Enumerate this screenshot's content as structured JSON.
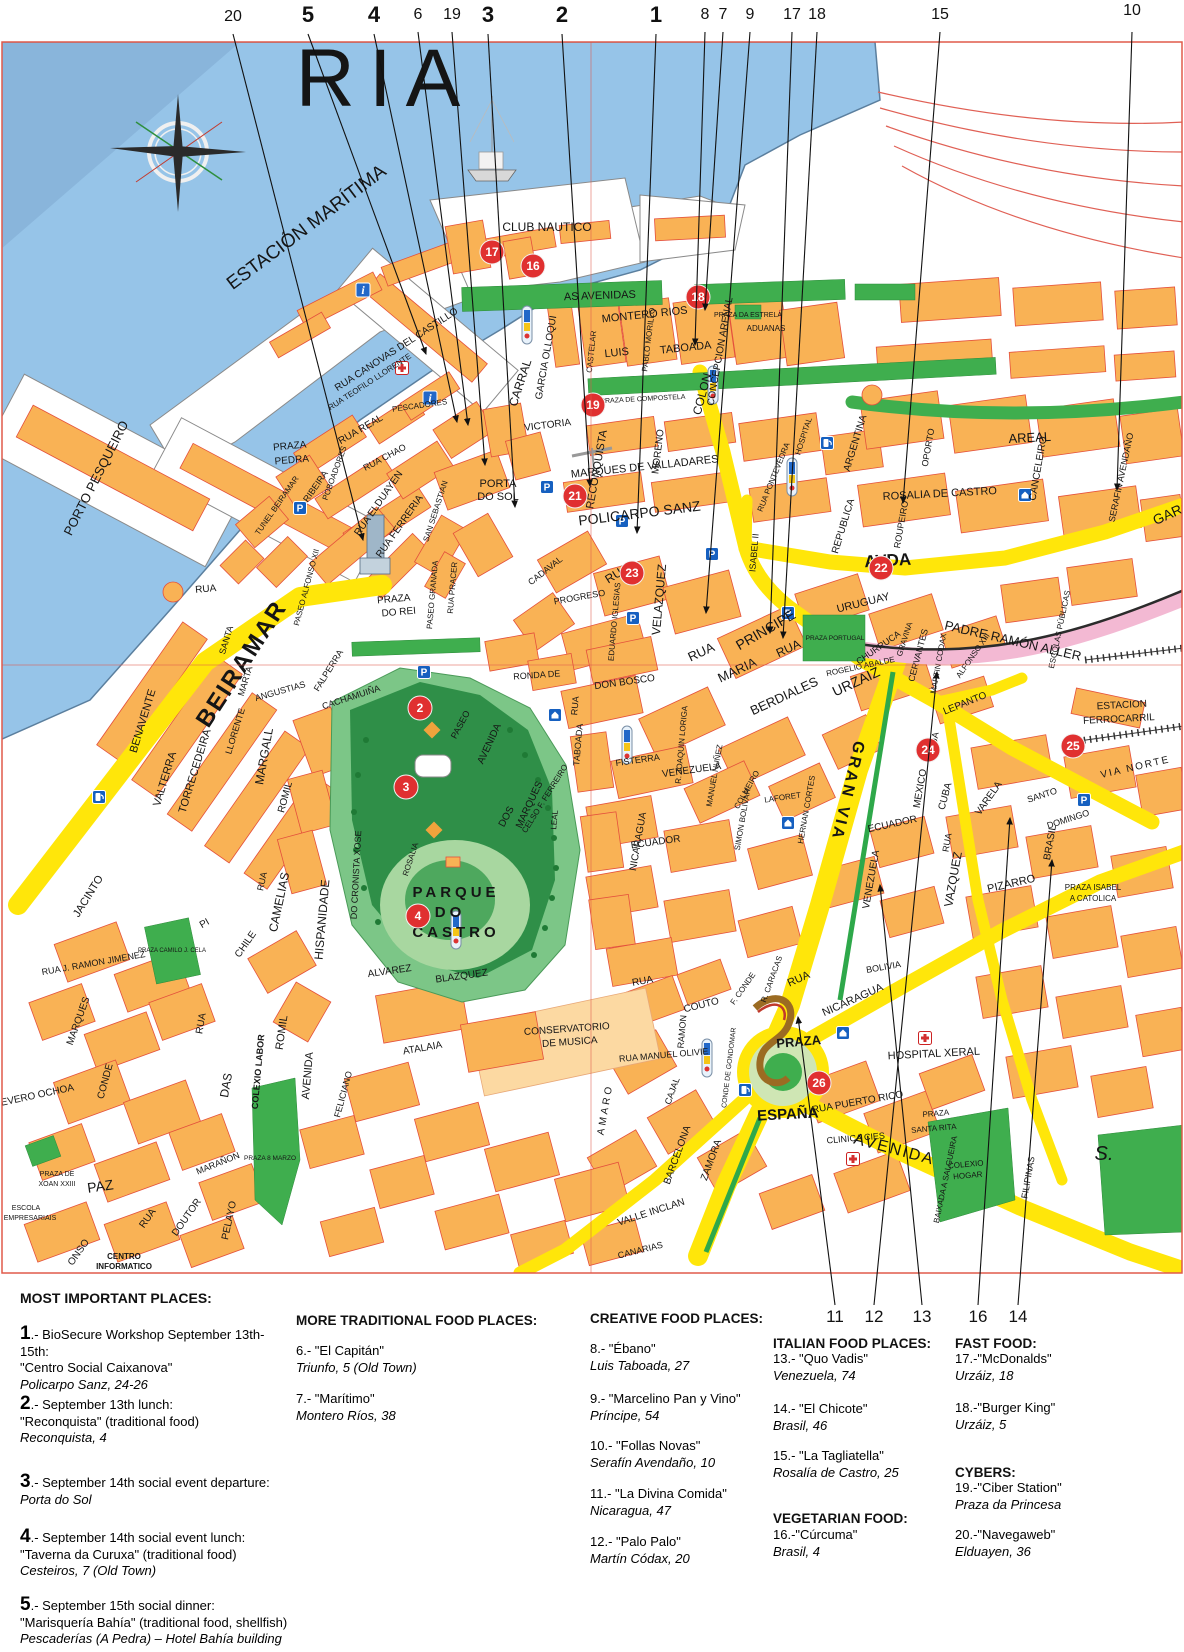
{
  "colors": {
    "water": "#96c4e8",
    "building": "#f9b255",
    "road_yellow": "#ffe60a",
    "park_green": "#2f9e45",
    "strip_green": "#3fae4e",
    "railway_pink": "#f3b9d3",
    "marker_red": "#e03030",
    "sign_blue": "#1660c0",
    "border_red": "#e05a4a"
  },
  "icons": {
    "parking": "P",
    "info": "i"
  },
  "top_callouts": [
    {
      "n": "20",
      "bold": false
    },
    {
      "n": "5",
      "bold": true
    },
    {
      "n": "4",
      "bold": true
    },
    {
      "n": "6",
      "bold": false
    },
    {
      "n": "19",
      "bold": false
    },
    {
      "n": "3",
      "bold": true
    },
    {
      "n": "2",
      "bold": true
    },
    {
      "n": "1",
      "bold": true
    },
    {
      "n": "8",
      "bold": false
    },
    {
      "n": "7",
      "bold": false
    },
    {
      "n": "9",
      "bold": false
    },
    {
      "n": "17",
      "bold": false
    },
    {
      "n": "18",
      "bold": false
    },
    {
      "n": "15",
      "bold": false
    },
    {
      "n": "10",
      "bold": false
    }
  ],
  "bottom_callouts": [
    "11",
    "12",
    "13",
    "16",
    "14"
  ],
  "map": {
    "markers": [
      "17",
      "16",
      "18",
      "19",
      "21",
      "22",
      "23",
      "2",
      "3",
      "4",
      "24",
      "25",
      "26"
    ],
    "labels": [
      "ESTACIÓN MARÍTIMA",
      "CLUB NAUTICO",
      "PORTO PESQUEIRO",
      "BEIRAMAR",
      "AS AVENIDAS",
      "MONTERO RIOS",
      "LUIS",
      "TABOADA",
      "PABLO MORILLO",
      "GARCIA OLLOQUI",
      "CASTELAR",
      "CARRAL",
      "VICTORIA",
      "CONCEPCION ARENAL",
      "PRAZA DA ESTRELA",
      "ADUANAS",
      "PRAZA DE COMPOSTELA",
      "COLON",
      "AREAL",
      "ROSALIA DE CASTRO",
      "ARGENTINA",
      "REPUBLICA",
      "OPORTO",
      "ROUPEIRO",
      "CANCELEIRO",
      "SERAFIN AVENDAÑO",
      "HOSPITAL",
      "RUA PONTEVEDRA",
      "AVDA",
      "GARC",
      "RUA CANOVAS DEL CASTILLO",
      "RUA TEOFILO LLORENTE",
      "RUA REAL",
      "RUA CHAO",
      "PRAZA",
      "PEDRA",
      "PESCADORES",
      "PORTA",
      "DO SOL",
      "RUA ELDUAYEN",
      "RUA FERRERIA",
      "SAN SEBASTIAN",
      "POBOADORES",
      "RIBEIRA",
      "TUNEL BEIRAMAR",
      "RECONQUISTA",
      "MORENO",
      "VELAZQUEZ",
      "MARQUES DE VALLADARES",
      "POLICARPO SANZ",
      "RUA",
      "PRINCIPE",
      "EDUARDO IGLESIAS",
      "PROGRESO",
      "CADAVAL",
      "DON BOSCO",
      "RONDA DE",
      "RUA",
      "MARIA",
      "BERDIALES",
      "RUA",
      "URZAIZ",
      "ISABEL II",
      "URUGUAY",
      "PRAZA PORTUGAL",
      "CHURRUCA",
      "GRAVINA",
      "ROGELIO ABALDE",
      "CERVANTES",
      "MARTIN CODAX",
      "ALFONSO XIII",
      "PADRE RAMÓN ALLER",
      "ESCOLAS PÚBLICAS",
      "LEPANTO",
      "ESTACION",
      "FERROCARRIL",
      "VIA NORTE",
      "FISTERRA",
      "R. JOAQUIN LORIGA",
      "MANUEL NUÑEZ",
      "COLMEIRO",
      "LAFORET",
      "HERNAN CORTES",
      "ECUADOR",
      "ECUADOR",
      "VENEZUELA",
      "VENEZUELA",
      "NICARAGUA",
      "SIMON BOLIVAR",
      "RUA",
      "TABOADA",
      "LEAL",
      "BOLIVIA",
      "GRAN VIA",
      "MEXICO",
      "CUBA",
      "RUA",
      "VAZQUEZ",
      "RUA",
      "VARELA",
      "SANTO",
      "DOMINGO",
      "BRASIL",
      "PIZARRO",
      "PRAZA ISABEL",
      "A CATOLICA",
      "HOSPITAL XERAL",
      "RUA PUERTO RICO",
      "PRAZA",
      "SANTA RITA",
      "BAIXADA A SALGUEIRA",
      "CLINICA CIES",
      "RUA",
      "NICARAGUA",
      "PRAZA",
      "ESPAÑA",
      "RUA MANUEL OLIVIE",
      "CONDE DE GONDOMAR",
      "RAMON",
      "CAJAL",
      "F. CONDE",
      "R. CARACAS",
      "RUA",
      "COUTO",
      "BARCELONA",
      "ZAMORA",
      "VALLE INCLAN",
      "AMARO",
      "CANARIAS",
      "AVENIDA",
      "COLEXIO",
      "HOGAR",
      "FILIPINAS",
      "S.",
      "CONSERVATORIO",
      "DE MUSICA",
      "ATALAIA",
      "ALVAREZ",
      "BLAZQUEZ",
      "FELICIANO",
      "PARQUE",
      "DO",
      "CASTRO",
      "PASEO",
      "AVENIDA",
      "DOS",
      "MARQUES",
      "CELSO F. FERREIRO",
      "ROSALIA",
      "DO CRONISTA XOSE",
      "FALPERRA",
      "CACHAMUIÑA",
      "PRAZA",
      "DO REI",
      "PASEO ALFONSO XII",
      "PASEO GRANADA",
      "RUA PRACER",
      "HISPANIDADE",
      "CAMELIAS",
      "RUA",
      "CHILE",
      "PI",
      "JACINTO",
      "RUA J. RAMON JIMENEZ",
      "MARQUES",
      "CONDE",
      "EVERO OCHOA",
      "PRAZA DE",
      "XOAN XXIII",
      "PAZ",
      "ESCOLA",
      "EMPRESARIAIS",
      "RUA",
      "DOUTOR",
      "PELAYO",
      "MARAÑON",
      "DAS",
      "RUA",
      "COLEXIO LABOR",
      "ROMIL",
      "AVENIDA",
      "ROMIL",
      "MARGALL",
      "ANGUSTIAS",
      "LLORENTE",
      "SANTA",
      "MARTA",
      "TORRECEDEIRA",
      "VALTERRA",
      "BENAVENTE",
      "RUA",
      "CENTRO",
      "INFORMATICO",
      "ONSO",
      "PRAZA CAMILO J. CELA",
      "PRAZA 8 MARZO",
      "RIA"
    ]
  },
  "legend": {
    "important": {
      "heading": "MOST IMPORTANT PLACES:",
      "items": [
        {
          "num": "1",
          "head": ".- BioSecure Workshop September 13th-15th:",
          "body": "\"Centro Social Caixanova\"",
          "addr": "Policarpo Sanz, 24-26"
        },
        {
          "num": "2",
          "head": ".- September 13th lunch:",
          "body": "\"Reconquista\" (traditional food)",
          "addr": "Reconquista, 4"
        },
        {
          "num": "3",
          "head": ".- September 14th social event departure:",
          "addr": "Porta do Sol"
        },
        {
          "num": "4",
          "head": ".- September 14th social event lunch:",
          "body": "\"Taverna da Curuxa\" (traditional food)",
          "addr": "Cesteiros, 7 (Old Town)"
        },
        {
          "num": "5",
          "head": ".- September 15th social dinner:",
          "body": "\"Marisquería Bahía\" (traditional food, shellfish)",
          "addr": "Pescaderías (A Pedra) – Hotel Bahía building"
        }
      ]
    },
    "traditional": {
      "heading": "MORE TRADITIONAL FOOD PLACES:",
      "items": [
        {
          "name": "6.- \"El Capitán\"",
          "addr": "Triunfo, 5 (Old Town)"
        },
        {
          "name": "7.- \"Marítimo\"",
          "addr": "Montero Ríos, 38"
        }
      ]
    },
    "creative": {
      "heading": "CREATIVE FOOD PLACES:",
      "items": [
        {
          "name": "8.- \"Ébano\"",
          "addr": "Luis Taboada, 27"
        },
        {
          "name": "9.- \"Marcelino Pan y Vino\"",
          "addr": "Príncipe, 54"
        },
        {
          "name": "10.- \"Follas Novas\"",
          "addr": "Serafín Avendaño, 10"
        },
        {
          "name": "11.- \"La Divina Comida\"",
          "addr": "Nicaragua, 47"
        },
        {
          "name": "12.- \"Palo Palo\"",
          "addr": "Martín Códax, 20"
        }
      ]
    },
    "italian": {
      "heading": "ITALIAN FOOD PLACES:",
      "items": [
        {
          "name": "13.- \"Quo Vadis\"",
          "addr": "Venezuela, 74"
        },
        {
          "name": "14.- \"El Chicote\"",
          "addr": "Brasil, 46"
        },
        {
          "name": "15.- \"La Tagliatella\"",
          "addr": "Rosalía de Castro, 25"
        }
      ]
    },
    "vegetarian": {
      "heading": "VEGETARIAN FOOD:",
      "items": [
        {
          "name": "16.-\"Cúrcuma\"",
          "addr": "Brasil, 4"
        }
      ]
    },
    "fastfood": {
      "heading": "FAST FOOD:",
      "items": [
        {
          "name": "17.-\"McDonalds\"",
          "addr": "Urzáiz, 18"
        },
        {
          "name": "18.-\"Burger King\"",
          "addr": "Urzáiz, 5"
        }
      ]
    },
    "cybers": {
      "heading": "CYBERS:",
      "items": [
        {
          "name": "19.-\"Ciber Station\"",
          "addr": "Praza da Princesa"
        },
        {
          "name": "20.-\"Navegaweb\"",
          "addr": "Elduayen, 36"
        }
      ]
    }
  }
}
